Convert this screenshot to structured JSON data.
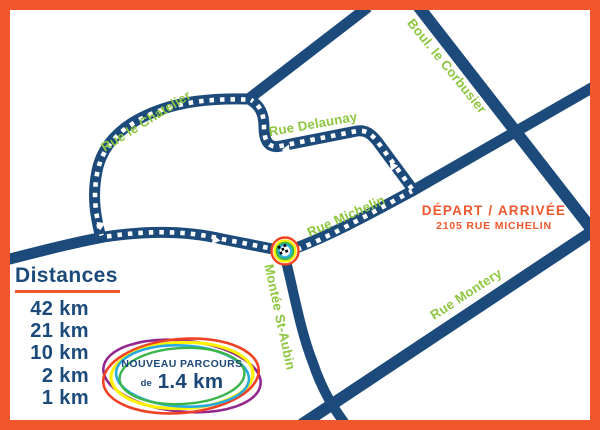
{
  "map": {
    "colors": {
      "frame_orange": "#f1572c",
      "road_navy": "#1b4a7b",
      "street_green": "#8dc63f",
      "logo_purple": "#92278f",
      "logo_red": "#ef4123",
      "logo_yellow": "#fff200",
      "logo_cyan": "#29abe2",
      "logo_green": "#3ab54a"
    }
  },
  "streets": {
    "chatelier": "Rue le Chatelier",
    "delaunay": "Rue Delaunay",
    "corbusier": "Boul. le Corbusier",
    "michelin": "Rue Michelin",
    "montery": "Rue Montery",
    "staubin": "Montée St-Aubin"
  },
  "depart": {
    "title": "DÉPART / ARRIVÉE",
    "address": "2105 RUE MICHELIN"
  },
  "distances": {
    "title": "Distances",
    "items": [
      "42 km",
      "21 km",
      "10 km",
      "2 km",
      "1 km"
    ]
  },
  "logo": {
    "line1": "NOUVEAU PARCOURS",
    "de": "de",
    "value": "1.4 km"
  }
}
